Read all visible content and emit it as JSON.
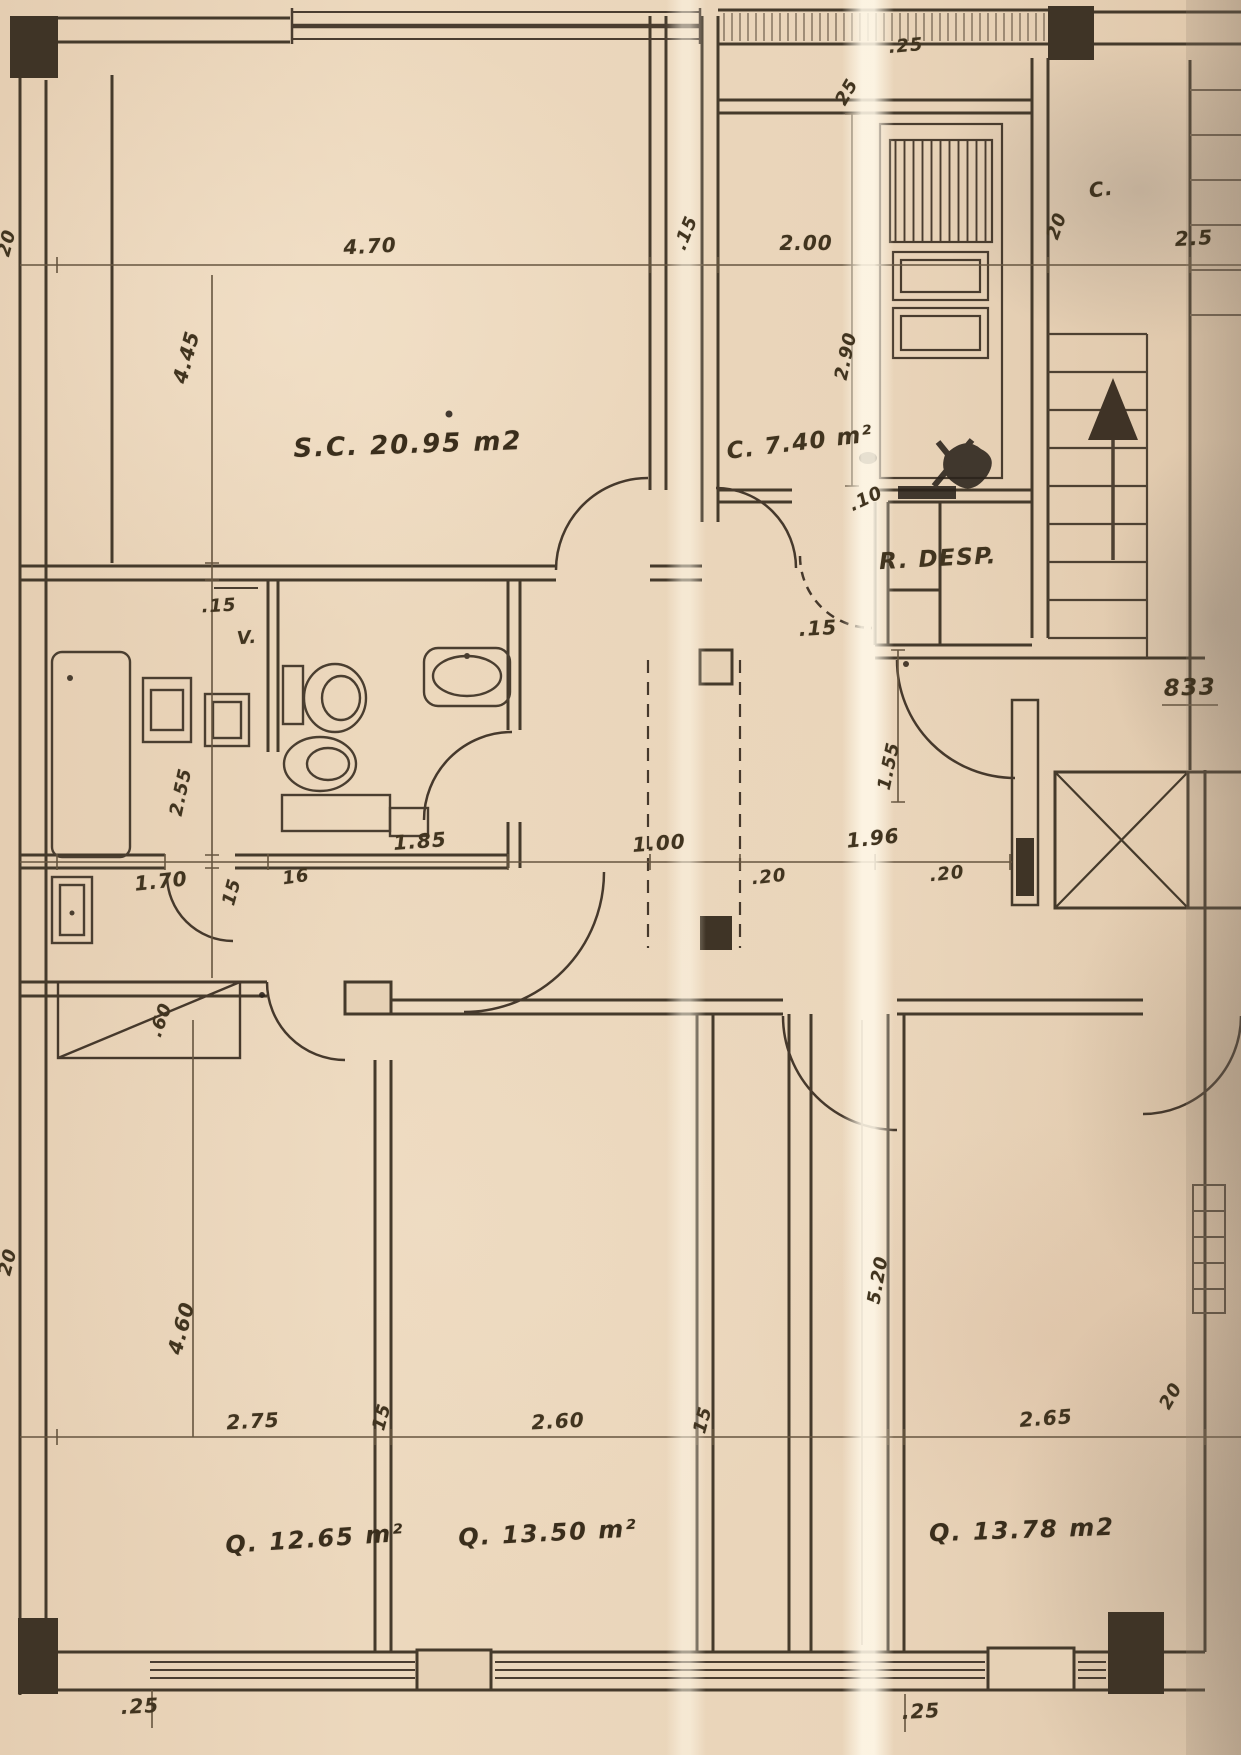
{
  "labels": {
    "dim_470": "4.70",
    "dim_15_top": ".15",
    "dim_200": "2.00",
    "dim_25_top": ".25",
    "dim_25_vert": "25",
    "closet_c": "C.",
    "dim_20_stair": "20",
    "dim_25_right": "2.5",
    "dim_290": "2.90",
    "dim_445": "4.45",
    "dim_20_left_top": "20",
    "room_living": "S.C. 20.95 m2",
    "room_kitchen": "C. 7.40 m²",
    "dim_10": ".10",
    "room_pantry": "R. DESP.",
    "dim_15_pantry": ".15",
    "num_833": "833",
    "dim_15_bath": ".15",
    "vent": "V.",
    "dim_255": "2.55",
    "dim_185": "1.85",
    "dim_170": "1.70",
    "dim_15_hall": "15",
    "dim_16": "16",
    "dim_100": "1.00",
    "dim_20_a": ".20",
    "dim_196": "1.96",
    "dim_20_b": ".20",
    "dim_155": "1.55",
    "dim_60": ".60",
    "dim_20_left_bottom": "20",
    "dim_460": "4.60",
    "dim_275": "2.75",
    "dim_15_bed1": "15",
    "dim_260": "2.60",
    "dim_15_bed2": "15",
    "dim_265": "2.65",
    "dim_20_bed3": "20",
    "dim_520": "5.20",
    "room_bedroom1": "Q. 12.65 m²",
    "room_bedroom2": "Q. 13.50 m²",
    "room_bedroom3": "Q. 13.78 m2",
    "dim_25_bottom_left": ".25",
    "dim_25_bottom_mid": ".25"
  }
}
